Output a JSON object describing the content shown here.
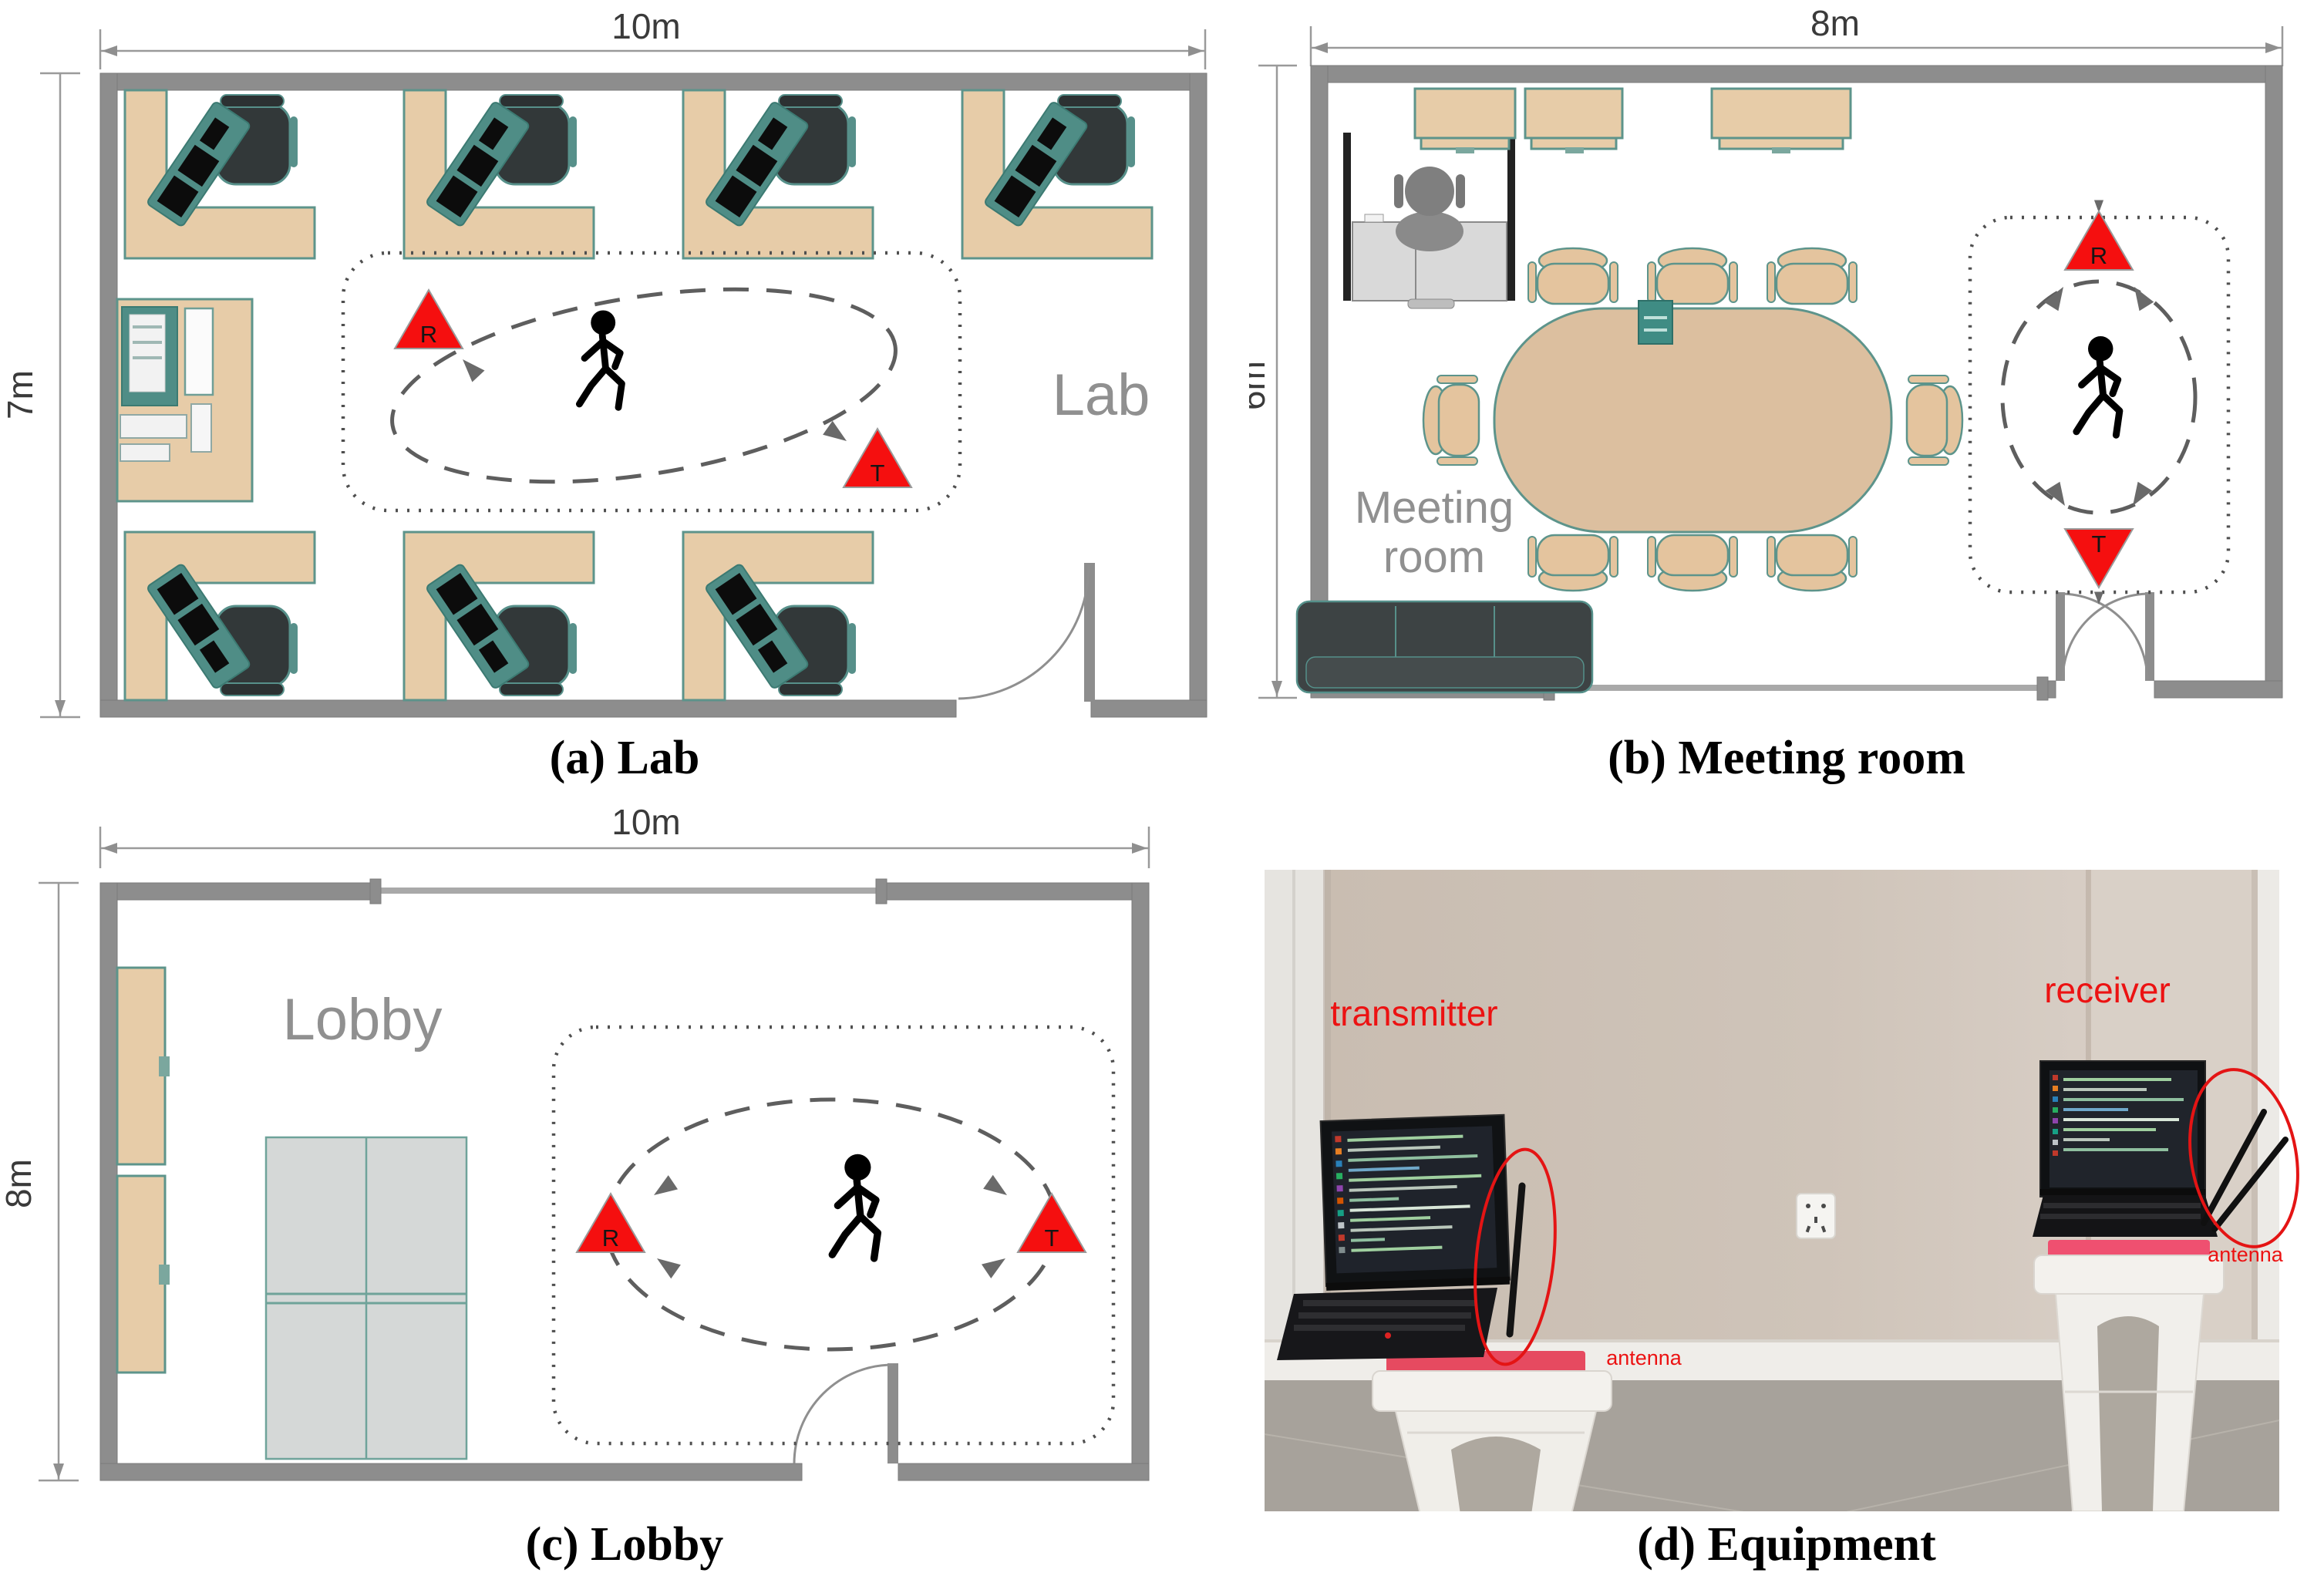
{
  "colors": {
    "marker_red": "#f50f0f",
    "annotation_red": "#ec1212",
    "wall_gray": "#8d8d8d",
    "desk_tan": "#e7cca8",
    "furniture_teal": "#4f8d86",
    "room_label_gray": "#909090"
  },
  "lab": {
    "caption": "(a) Lab",
    "room_label": "Lab",
    "width_label": "10m",
    "height_label": "7m",
    "marker_r": "R",
    "marker_t": "T"
  },
  "meeting": {
    "caption": "(b) Meeting room",
    "room_label_line1": "Meeting",
    "room_label_line2": "room",
    "width_label": "8m",
    "height_label": "6m",
    "marker_r": "R",
    "marker_t": "T"
  },
  "lobby": {
    "caption": "(c) Lobby",
    "room_label": "Lobby",
    "width_label": "10m",
    "height_label": "8m",
    "marker_r": "R",
    "marker_t": "T"
  },
  "equipment": {
    "caption": "(d) Equipment",
    "transmitter_label": "transmitter",
    "receiver_label": "receiver",
    "antenna_label_left": "antenna",
    "antenna_label_right": "antenna"
  }
}
